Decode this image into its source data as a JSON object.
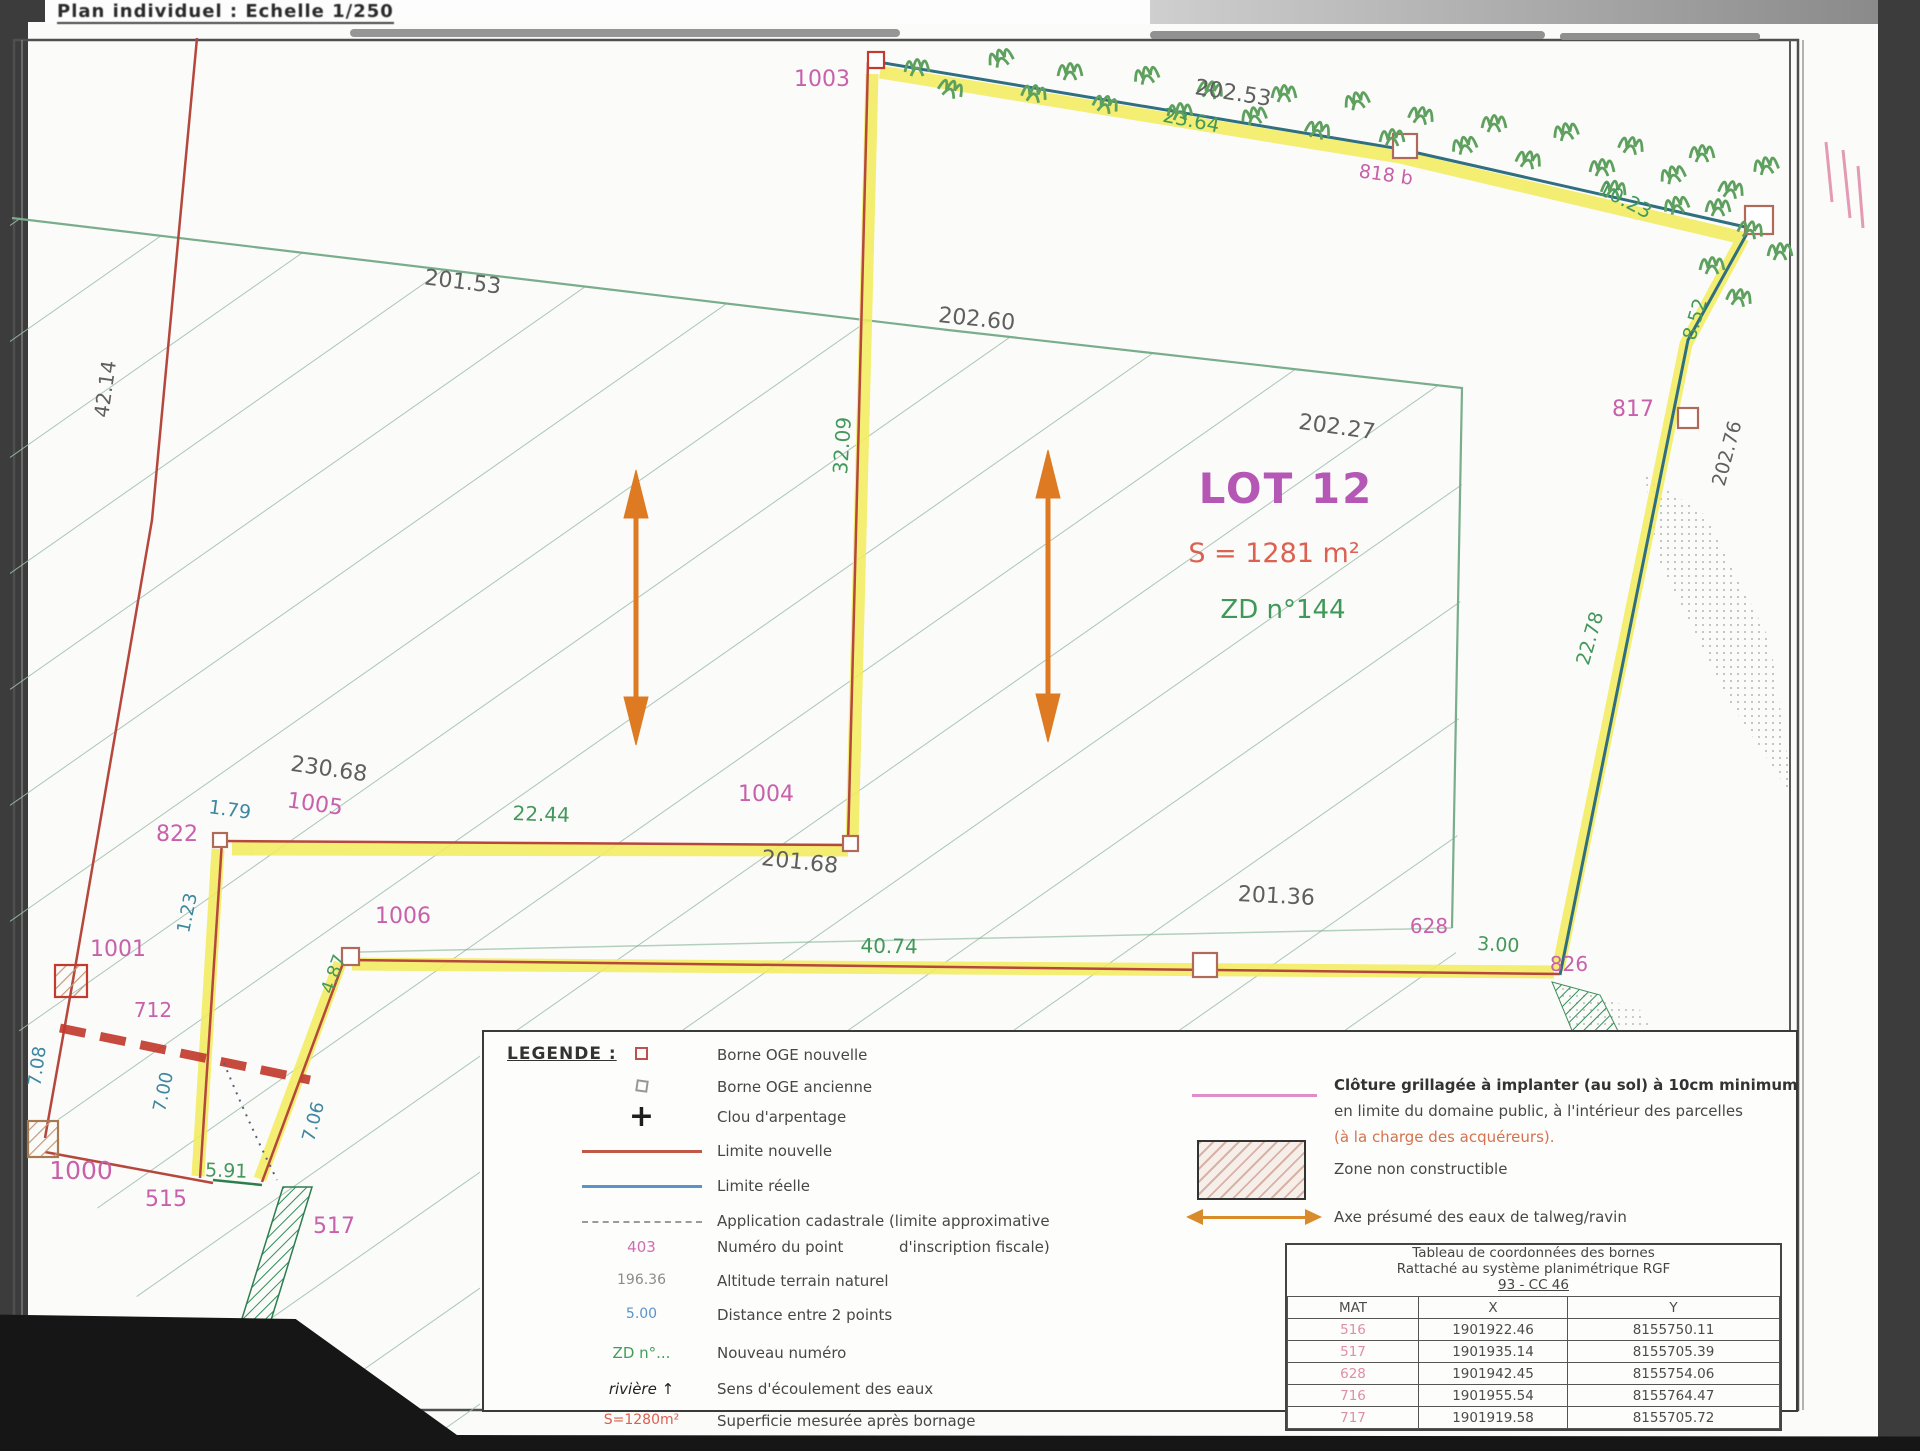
{
  "header": {
    "title": "Plan individuel : Echelle 1/250"
  },
  "map": {
    "labels": [
      {
        "text": "1003",
        "kind": "pt"
      },
      {
        "text": "202.53",
        "kind": "dim"
      },
      {
        "text": "23.64",
        "kind": "dist"
      },
      {
        "text": "818 b",
        "kind": "pt"
      },
      {
        "text": "10.23",
        "kind": "dist"
      },
      {
        "text": "8.52",
        "kind": "dist"
      },
      {
        "text": "817",
        "kind": "pt"
      },
      {
        "text": "202.76",
        "kind": "dim"
      },
      {
        "text": "22.78",
        "kind": "dist"
      },
      {
        "text": "201.53",
        "kind": "dim"
      },
      {
        "text": "202.60",
        "kind": "dim"
      },
      {
        "text": "42.14",
        "kind": "dim"
      },
      {
        "text": "32.09",
        "kind": "dist"
      },
      {
        "text": "202.27",
        "kind": "dim"
      },
      {
        "text": "230.68",
        "kind": "dim"
      },
      {
        "text": "1005",
        "kind": "pt"
      },
      {
        "text": "1.79",
        "kind": "dist2"
      },
      {
        "text": "822",
        "kind": "pt"
      },
      {
        "text": "22.44",
        "kind": "dist"
      },
      {
        "text": "1004",
        "kind": "pt"
      },
      {
        "text": "201.68",
        "kind": "dim"
      },
      {
        "text": "1.23",
        "kind": "dist2"
      },
      {
        "text": "1001",
        "kind": "pt"
      },
      {
        "text": "4.87",
        "kind": "dist"
      },
      {
        "text": "1006",
        "kind": "pt"
      },
      {
        "text": "40.74",
        "kind": "dist"
      },
      {
        "text": "201.36",
        "kind": "dim"
      },
      {
        "text": "628",
        "kind": "pt"
      },
      {
        "text": "3.00",
        "kind": "dist"
      },
      {
        "text": "826",
        "kind": "pt"
      },
      {
        "text": "712",
        "kind": "pt"
      },
      {
        "text": "7.08",
        "kind": "dist2"
      },
      {
        "text": "7.00",
        "kind": "dist2"
      },
      {
        "text": "7.06",
        "kind": "dist2"
      },
      {
        "text": "1000",
        "kind": "pt"
      },
      {
        "text": "5.91",
        "kind": "dist"
      },
      {
        "text": "515",
        "kind": "pt"
      },
      {
        "text": "517",
        "kind": "pt"
      },
      {
        "text": "LOT 12",
        "kind": "lot"
      },
      {
        "text": "S = 1281 m²",
        "kind": "area"
      },
      {
        "text": "ZD n°144",
        "kind": "ref"
      }
    ]
  },
  "legend": {
    "heading": "LEGENDE :",
    "items": [
      {
        "symbol": "borne-new-square",
        "symbol_text": "",
        "label": "Borne OGE nouvelle"
      },
      {
        "symbol": "borne-old-square",
        "symbol_text": "",
        "label": "Borne OGE ancienne"
      },
      {
        "symbol": "cross",
        "symbol_text": "+",
        "label": "Clou d'arpentage"
      },
      {
        "symbol": "line-red",
        "symbol_text": "",
        "label": "Limite nouvelle"
      },
      {
        "symbol": "line-blue",
        "symbol_text": "",
        "label": "Limite réelle"
      },
      {
        "symbol": "line-dash",
        "symbol_text": "",
        "label": "Application cadastrale (limite approximative"
      },
      {
        "symbol": "point-number",
        "symbol_text": "403",
        "label": "Numéro du point"
      },
      {
        "symbol": "altitude",
        "symbol_text": "196.36",
        "label": "Altitude terrain naturel"
      },
      {
        "symbol": "distance",
        "symbol_text": "5.00",
        "label": "Distance entre 2 points"
      },
      {
        "symbol": "new-number",
        "symbol_text": "ZD n°...",
        "label": "Nouveau numéro"
      },
      {
        "symbol": "flow",
        "symbol_text": "rivière ↑",
        "label": "Sens d'écoulement des eaux"
      },
      {
        "symbol": "area",
        "symbol_text": "S=1280m²",
        "label": "Superficie mesurée après bornage"
      }
    ],
    "item6_continuation": "d'inscription fiscale)",
    "right_items": [
      {
        "symbol": "fence-line",
        "lines": [
          "Clôture grillagée à implanter (au sol) à 10cm minimum",
          "en limite du domaine public, à l'intérieur des parcelles",
          "(à la charge des acquéreurs)."
        ]
      },
      {
        "symbol": "hatched-zone",
        "lines": [
          "Zone non constructible"
        ]
      },
      {
        "symbol": "flow-axis-arrow",
        "lines": [
          "Axe présumé des eaux de talweg/ravin"
        ]
      }
    ]
  },
  "coord_table": {
    "title_lines": [
      "Tableau de coordonnées des bornes",
      "Rattaché au système planimétrique RGF",
      "93 - CC 46"
    ],
    "headers": [
      "MAT",
      "X",
      "Y"
    ],
    "rows": [
      [
        "516",
        "1901922.46",
        "8155750.11"
      ],
      [
        "517",
        "1901935.14",
        "8155705.39"
      ],
      [
        "628",
        "1901942.45",
        "8155754.06"
      ],
      [
        "716",
        "1901955.54",
        "8155764.47"
      ],
      [
        "717",
        "1901919.58",
        "8155705.72"
      ]
    ]
  }
}
